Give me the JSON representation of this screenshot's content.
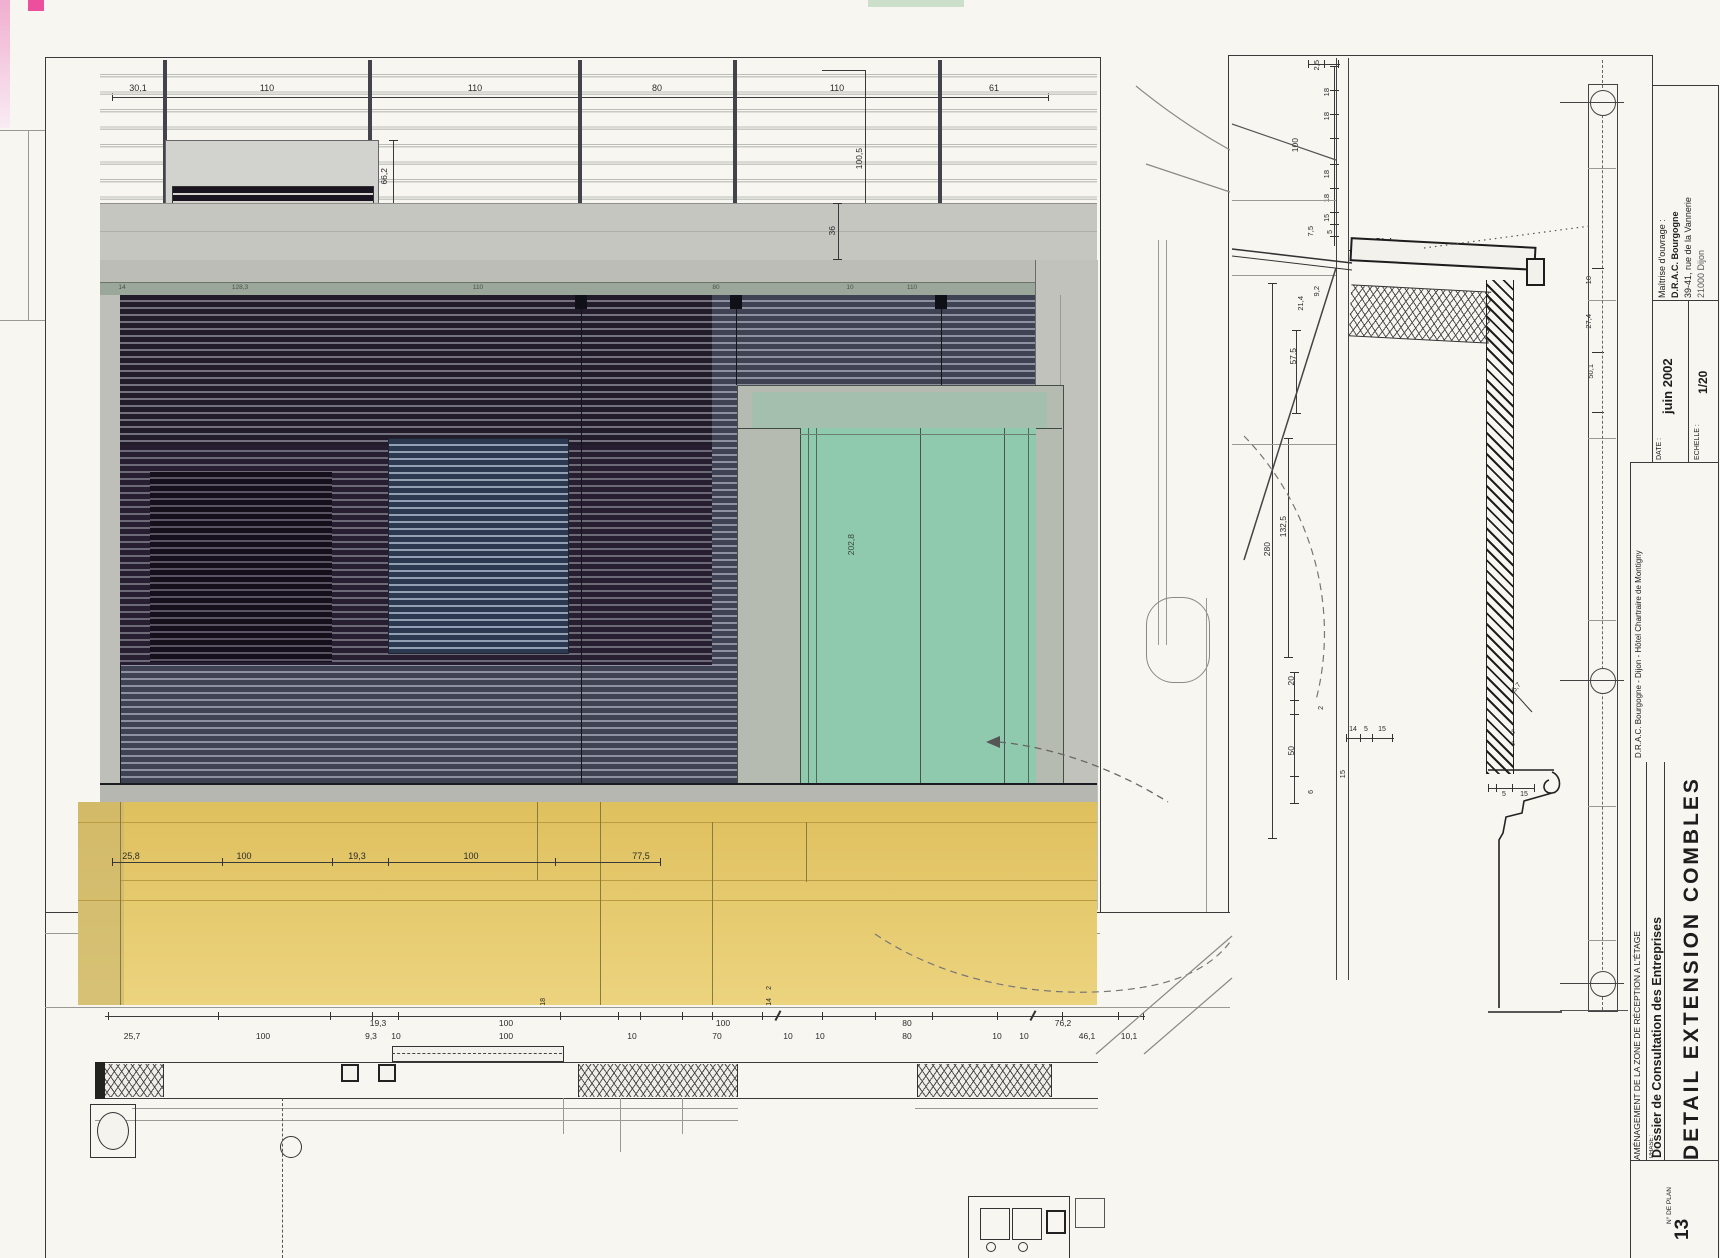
{
  "title_block": {
    "owner_label": "Maîtrise d'ouvrage :",
    "owner_line1": "D.R.A.C. Bourgogne",
    "owner_line2": "39-41, rue de la Vannerie",
    "owner_line3": "21000 Dijon",
    "date_label": "DATE :",
    "date_value": "juin 2002",
    "scale_label": "ECHELLE :",
    "scale_value": "1/20",
    "project_line": "D.R.A.C. Bourgogne - Dijon - Hôtel Chartraire de Montigny",
    "zone_line": "AMÉNAGEMENT DE LA ZONE DE RÉCEPTION A L'ÉTAGE",
    "phase_label": "PHASE :",
    "phase_value": "Dossier de Consultation des Entreprises",
    "drawing_title": "DETAIL EXTENSION COMBLES",
    "plan_no_label": "N° DE PLAN",
    "plan_no": "13"
  },
  "elevation": {
    "top_dims": [
      "30,1",
      "110",
      "110",
      "80",
      "110",
      "61"
    ],
    "panel_dim": "66,2",
    "height_dim": "100,5",
    "band_height_dim": "36",
    "band_dims": [
      "14",
      "128,3",
      "110",
      "80",
      "10",
      "110",
      "45",
      "15"
    ],
    "window_height": "202,8",
    "window_sill": "50",
    "window_width": "162,5",
    "base_dims": [
      "25,8",
      "100",
      "19,3",
      "100",
      "77,5"
    ]
  },
  "plan": {
    "upper_dims": [
      "19,3",
      "100",
      "100",
      "80",
      "76,2"
    ],
    "lower_dims": [
      "25,7",
      "100",
      "9,3",
      "10",
      "100",
      "10",
      "70",
      "10",
      "10",
      "80",
      "10",
      "10",
      "46,1",
      "10,1"
    ],
    "leaf_dim": "18",
    "jamb_dims": [
      "14",
      "2"
    ]
  },
  "section": {
    "top_dim": "2,5",
    "chain_a": [
      "18",
      "18",
      "100",
      "18",
      "18",
      "15",
      "5",
      "7,5"
    ],
    "mid_dims": [
      "9,2",
      "21,4",
      "57,5",
      "132,5",
      "280"
    ],
    "low_dims": [
      "20",
      "2",
      "50",
      "6",
      "15"
    ],
    "eave_dim": "51,4",
    "axis_dims": [
      "10",
      "27,4",
      "50,1"
    ],
    "foot_dims": [
      "14",
      "5",
      "15"
    ],
    "gutter_dims": [
      "5",
      "15"
    ],
    "diag_dim": "5,7",
    "tick_dims": [
      "5",
      "5"
    ]
  }
}
